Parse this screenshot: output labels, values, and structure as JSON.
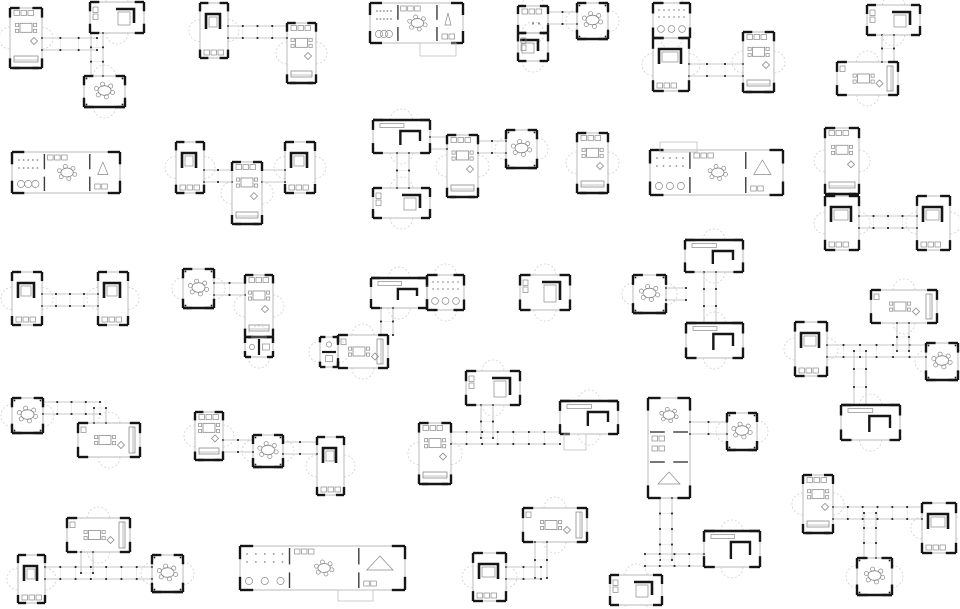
{
  "figure": {
    "kind": "architectural-floor-plan-variations",
    "description": "grid of small modular house plan clusters",
    "canvas": {
      "width": 960,
      "height": 609,
      "background": "#ffffff"
    },
    "colors": {
      "wall": "#161616",
      "thin": "#9c9c9c",
      "furniture": "#8a8a8a",
      "arc": "#cfcfcf",
      "corridor": "#b6b6b6",
      "cross": "#d8d8d8",
      "tick": "#1a1a1a",
      "porch": "#c2c2c2",
      "partition": "#3c3c3c"
    },
    "cluster_count": 26,
    "clusters": [
      {
        "id": "c1",
        "modules": [
          {
            "x": 10,
            "y": 8,
            "w": 32,
            "h": 60,
            "type": "living"
          },
          {
            "x": 90,
            "y": 2,
            "w": 54,
            "h": 31,
            "type": "bed"
          },
          {
            "x": 84,
            "y": 76,
            "w": 41,
            "h": 31,
            "type": "dining"
          }
        ],
        "corridors": [
          {
            "x1": 42,
            "y1": 44,
            "x2": 97,
            "y2": 44
          },
          {
            "x1": 97,
            "y1": 33,
            "x2": 97,
            "y2": 76
          }
        ]
      },
      {
        "id": "c2",
        "modules": [
          {
            "x": 200,
            "y": 3,
            "w": 28,
            "h": 55,
            "type": "bed"
          },
          {
            "x": 287,
            "y": 23,
            "w": 29,
            "h": 60,
            "type": "living"
          }
        ],
        "corridors": [
          {
            "x1": 228,
            "y1": 32,
            "x2": 287,
            "y2": 32
          }
        ]
      },
      {
        "id": "c3",
        "modules": [
          {
            "x": 370,
            "y": 3,
            "w": 93,
            "h": 40,
            "type": "compound"
          },
          {
            "x": 420,
            "y": 43,
            "w": 36,
            "h": 13,
            "type": "porch"
          }
        ],
        "corridors": []
      },
      {
        "id": "c4",
        "modules": [
          {
            "x": 518,
            "y": 6,
            "w": 30,
            "h": 27,
            "type": "util"
          },
          {
            "x": 518,
            "y": 33,
            "w": 30,
            "h": 28,
            "type": "bed"
          },
          {
            "x": 577,
            "y": 3,
            "w": 31,
            "h": 36,
            "type": "dining"
          }
        ],
        "corridors": [
          {
            "x1": 548,
            "y1": 18,
            "x2": 577,
            "y2": 18
          }
        ]
      },
      {
        "id": "c5",
        "modules": [
          {
            "x": 653,
            "y": 3,
            "w": 37,
            "h": 35,
            "type": "dorm"
          },
          {
            "x": 653,
            "y": 38,
            "w": 36,
            "h": 53,
            "type": "bed"
          },
          {
            "x": 743,
            "y": 32,
            "w": 31,
            "h": 60,
            "type": "living"
          }
        ],
        "corridors": [
          {
            "x1": 689,
            "y1": 70,
            "x2": 743,
            "y2": 70
          }
        ]
      },
      {
        "id": "c6",
        "modules": [
          {
            "x": 867,
            "y": 5,
            "w": 53,
            "h": 30,
            "type": "bed"
          },
          {
            "x": 837,
            "y": 62,
            "w": 61,
            "h": 33,
            "type": "living"
          }
        ],
        "corridors": [
          {
            "x1": 888,
            "y1": 35,
            "x2": 888,
            "y2": 62
          }
        ]
      },
      {
        "id": "c7",
        "modules": [
          {
            "x": 12,
            "y": 152,
            "w": 108,
            "h": 41,
            "type": "compound"
          }
        ],
        "corridors": []
      },
      {
        "id": "c8",
        "modules": [
          {
            "x": 176,
            "y": 142,
            "w": 28,
            "h": 51,
            "type": "bed"
          },
          {
            "x": 232,
            "y": 162,
            "w": 30,
            "h": 62,
            "type": "living"
          },
          {
            "x": 285,
            "y": 142,
            "w": 30,
            "h": 51,
            "type": "bed"
          }
        ],
        "corridors": [
          {
            "x1": 204,
            "y1": 176,
            "x2": 232,
            "y2": 176
          },
          {
            "x1": 262,
            "y1": 176,
            "x2": 285,
            "y2": 176
          }
        ]
      },
      {
        "id": "c9",
        "modules": [
          {
            "x": 373,
            "y": 120,
            "w": 57,
            "h": 33,
            "type": "lroom"
          },
          {
            "x": 373,
            "y": 188,
            "w": 57,
            "h": 30,
            "type": "bed"
          },
          {
            "x": 447,
            "y": 135,
            "w": 31,
            "h": 62,
            "type": "living"
          },
          {
            "x": 506,
            "y": 130,
            "w": 31,
            "h": 38,
            "type": "dining"
          }
        ],
        "corridors": [
          {
            "x1": 403,
            "y1": 153,
            "x2": 403,
            "y2": 188
          },
          {
            "x1": 430,
            "y1": 143,
            "x2": 447,
            "y2": 143
          },
          {
            "x1": 478,
            "y1": 147,
            "x2": 506,
            "y2": 147
          }
        ]
      },
      {
        "id": "c10",
        "modules": [
          {
            "x": 577,
            "y": 133,
            "w": 31,
            "h": 60,
            "type": "living"
          }
        ],
        "corridors": []
      },
      {
        "id": "c11",
        "modules": [
          {
            "x": 650,
            "y": 150,
            "w": 133,
            "h": 45,
            "type": "compound"
          },
          {
            "x": 660,
            "y": 142,
            "w": 37,
            "h": 10,
            "type": "porch"
          }
        ],
        "corridors": []
      },
      {
        "id": "c12",
        "modules": [
          {
            "x": 825,
            "y": 128,
            "w": 34,
            "h": 66,
            "type": "living"
          },
          {
            "x": 825,
            "y": 196,
            "w": 34,
            "h": 54,
            "type": "bed"
          },
          {
            "x": 917,
            "y": 196,
            "w": 33,
            "h": 54,
            "type": "bed"
          }
        ],
        "corridors": [
          {
            "x1": 859,
            "y1": 222,
            "x2": 917,
            "y2": 222
          }
        ]
      },
      {
        "id": "c13",
        "modules": [
          {
            "x": 12,
            "y": 272,
            "w": 30,
            "h": 53,
            "type": "bed"
          },
          {
            "x": 98,
            "y": 272,
            "w": 30,
            "h": 53,
            "type": "bed"
          }
        ],
        "corridors": [
          {
            "x1": 42,
            "y1": 300,
            "x2": 98,
            "y2": 300
          }
        ]
      },
      {
        "id": "c14",
        "modules": [
          {
            "x": 183,
            "y": 269,
            "w": 31,
            "h": 39,
            "type": "dining"
          },
          {
            "x": 245,
            "y": 275,
            "w": 28,
            "h": 62,
            "type": "living"
          },
          {
            "x": 245,
            "y": 337,
            "w": 28,
            "h": 20,
            "type": "bath"
          }
        ],
        "corridors": [
          {
            "x1": 214,
            "y1": 289,
            "x2": 245,
            "y2": 289
          }
        ]
      },
      {
        "id": "c15",
        "modules": [
          {
            "x": 371,
            "y": 278,
            "w": 56,
            "h": 30,
            "type": "lroom"
          },
          {
            "x": 427,
            "y": 275,
            "w": 37,
            "h": 35,
            "type": "dorm"
          },
          {
            "x": 320,
            "y": 337,
            "w": 18,
            "h": 30,
            "type": "bath"
          },
          {
            "x": 338,
            "y": 335,
            "w": 50,
            "h": 33,
            "type": "living"
          }
        ],
        "corridors": [
          {
            "x1": 387,
            "y1": 308,
            "x2": 387,
            "y2": 335
          }
        ]
      },
      {
        "id": "c16",
        "modules": [
          {
            "x": 520,
            "y": 275,
            "w": 50,
            "h": 35,
            "type": "bed"
          }
        ],
        "corridors": []
      },
      {
        "id": "c17",
        "modules": [
          {
            "x": 633,
            "y": 275,
            "w": 33,
            "h": 38,
            "type": "dining"
          },
          {
            "x": 685,
            "y": 240,
            "w": 58,
            "h": 32,
            "type": "lroom"
          },
          {
            "x": 686,
            "y": 323,
            "w": 57,
            "h": 35,
            "type": "lroom"
          }
        ],
        "corridors": [
          {
            "x1": 710,
            "y1": 272,
            "x2": 710,
            "y2": 323
          },
          {
            "x1": 666,
            "y1": 294,
            "x2": 686,
            "y2": 294
          }
        ]
      },
      {
        "id": "c18",
        "modules": [
          {
            "x": 871,
            "y": 290,
            "w": 66,
            "h": 33,
            "type": "living"
          },
          {
            "x": 795,
            "y": 322,
            "w": 32,
            "h": 54,
            "type": "bed"
          },
          {
            "x": 926,
            "y": 343,
            "w": 32,
            "h": 37,
            "type": "dining"
          },
          {
            "x": 841,
            "y": 405,
            "w": 59,
            "h": 35,
            "type": "lroom"
          }
        ],
        "corridors": [
          {
            "x1": 827,
            "y1": 351,
            "x2": 926,
            "y2": 351
          },
          {
            "x1": 903,
            "y1": 323,
            "x2": 903,
            "y2": 351
          },
          {
            "x1": 860,
            "y1": 351,
            "x2": 860,
            "y2": 405
          }
        ]
      },
      {
        "id": "c19",
        "modules": [
          {
            "x": 12,
            "y": 398,
            "w": 31,
            "h": 35,
            "type": "dining"
          },
          {
            "x": 78,
            "y": 423,
            "w": 62,
            "h": 34,
            "type": "living"
          }
        ],
        "corridors": [
          {
            "x1": 43,
            "y1": 408,
            "x2": 100,
            "y2": 408
          },
          {
            "x1": 100,
            "y1": 408,
            "x2": 100,
            "y2": 423
          }
        ]
      },
      {
        "id": "c20",
        "modules": [
          {
            "x": 195,
            "y": 412,
            "w": 28,
            "h": 48,
            "type": "living"
          },
          {
            "x": 253,
            "y": 435,
            "w": 30,
            "h": 32,
            "type": "dining"
          },
          {
            "x": 317,
            "y": 437,
            "w": 27,
            "h": 58,
            "type": "bed"
          }
        ],
        "corridors": [
          {
            "x1": 223,
            "y1": 446,
            "x2": 253,
            "y2": 446
          },
          {
            "x1": 283,
            "y1": 448,
            "x2": 317,
            "y2": 448
          }
        ]
      },
      {
        "id": "c21",
        "modules": [
          {
            "x": 466,
            "y": 371,
            "w": 54,
            "h": 34,
            "type": "bed"
          },
          {
            "x": 419,
            "y": 423,
            "w": 32,
            "h": 61,
            "type": "living"
          },
          {
            "x": 560,
            "y": 401,
            "w": 58,
            "h": 33,
            "type": "lroom"
          },
          {
            "x": 564,
            "y": 434,
            "w": 22,
            "h": 16,
            "type": "porch"
          }
        ],
        "corridors": [
          {
            "x1": 487,
            "y1": 405,
            "x2": 487,
            "y2": 438
          },
          {
            "x1": 451,
            "y1": 438,
            "x2": 560,
            "y2": 438
          }
        ]
      },
      {
        "id": "c22",
        "modules": [
          {
            "x": 648,
            "y": 398,
            "w": 42,
            "h": 100,
            "type": "compound"
          },
          {
            "x": 727,
            "y": 413,
            "w": 30,
            "h": 37,
            "type": "dining"
          },
          {
            "x": 704,
            "y": 531,
            "w": 56,
            "h": 36,
            "type": "lroom"
          },
          {
            "x": 610,
            "y": 575,
            "w": 52,
            "h": 30,
            "type": "bed"
          }
        ],
        "corridors": [
          {
            "x1": 690,
            "y1": 428,
            "x2": 727,
            "y2": 428
          },
          {
            "x1": 666,
            "y1": 498,
            "x2": 666,
            "y2": 560
          },
          {
            "x1": 645,
            "y1": 560,
            "x2": 704,
            "y2": 560
          }
        ]
      },
      {
        "id": "c24",
        "modules": [
          {
            "x": 18,
            "y": 555,
            "w": 27,
            "h": 48,
            "type": "bed"
          },
          {
            "x": 67,
            "y": 518,
            "w": 63,
            "h": 34,
            "type": "living"
          },
          {
            "x": 152,
            "y": 555,
            "w": 31,
            "h": 37,
            "type": "dining"
          }
        ],
        "corridors": [
          {
            "x1": 87,
            "y1": 552,
            "x2": 87,
            "y2": 573
          },
          {
            "x1": 45,
            "y1": 573,
            "x2": 152,
            "y2": 573
          }
        ]
      },
      {
        "id": "c25",
        "modules": [
          {
            "x": 240,
            "y": 546,
            "w": 165,
            "h": 44,
            "type": "compound"
          },
          {
            "x": 338,
            "y": 590,
            "w": 35,
            "h": 11,
            "type": "porch"
          }
        ],
        "corridors": []
      },
      {
        "id": "c26",
        "modules": [
          {
            "x": 473,
            "y": 553,
            "w": 33,
            "h": 48,
            "type": "bed"
          },
          {
            "x": 523,
            "y": 508,
            "w": 64,
            "h": 34,
            "type": "living"
          }
        ],
        "corridors": [
          {
            "x1": 541,
            "y1": 542,
            "x2": 541,
            "y2": 578
          },
          {
            "x1": 506,
            "y1": 573,
            "x2": 541,
            "y2": 573
          }
        ]
      },
      {
        "id": "c28",
        "modules": [
          {
            "x": 803,
            "y": 475,
            "w": 30,
            "h": 58,
            "type": "living"
          },
          {
            "x": 922,
            "y": 503,
            "w": 34,
            "h": 50,
            "type": "bed"
          },
          {
            "x": 857,
            "y": 558,
            "w": 35,
            "h": 37,
            "type": "dining"
          }
        ],
        "corridors": [
          {
            "x1": 833,
            "y1": 513,
            "x2": 922,
            "y2": 513
          },
          {
            "x1": 870,
            "y1": 513,
            "x2": 870,
            "y2": 558
          }
        ]
      }
    ]
  }
}
